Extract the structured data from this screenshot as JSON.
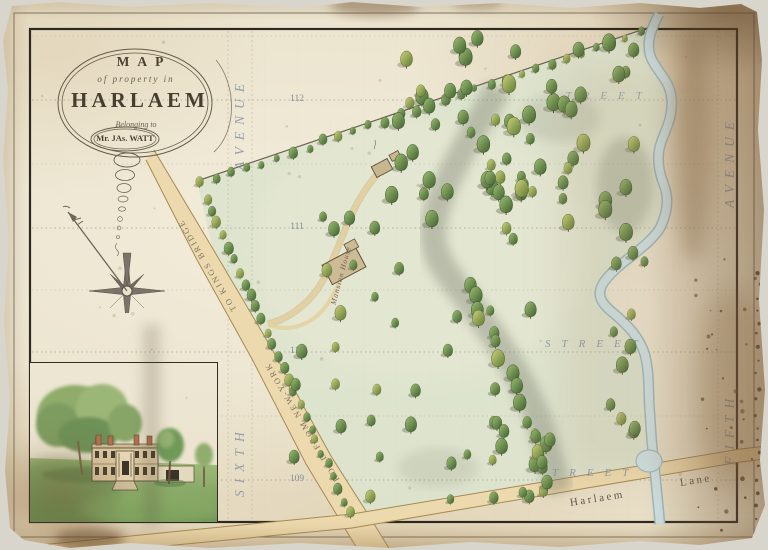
{
  "cartouche": {
    "word_map": "MAP",
    "line_of": "of property in",
    "word_harlaem": "HARLAEM",
    "line_belonging": "Belonging to",
    "owner": "Mr. JAs. WATT"
  },
  "roads": {
    "kingsbridge_upper": "TO KINGS BRIDGE",
    "kingsbridge_lower": "ROAD FROM NEW-YORK",
    "lane_name": "Harlaem",
    "lane_word": "Lane"
  },
  "avenues": {
    "sixth_upper": "AVENUE",
    "sixth_lower": "SIXTH",
    "fifth_upper": "AVENUE",
    "fifth_lower": "FIFTH"
  },
  "estate": {
    "mansion_label": "Mansion House"
  },
  "streets": [
    {
      "number": "112",
      "y": 100,
      "label": "STREET",
      "label_x": 549,
      "label_y": 90,
      "label_opacity": 0.8
    },
    {
      "number": "111",
      "y": 228,
      "label": "",
      "label_x": 0,
      "label_y": 0,
      "label_opacity": 0
    },
    {
      "number": "110",
      "y": 352,
      "label": "STREET",
      "label_x": 545,
      "label_y": 338,
      "label_opacity": 0.9
    },
    {
      "number": "109",
      "y": 480,
      "label": "TREET",
      "label_x": 552,
      "label_y": 467,
      "label_opacity": 0.9
    }
  ],
  "number_x": 282,
  "faint_lines": [
    36,
    164,
    290,
    416
  ],
  "avenue_lines": [
    228,
    252,
    718
  ],
  "colors": {
    "paper": "#eae2cc",
    "green": "#dce3cd",
    "road_fill": "#ecd9ad",
    "road_edge": "#a68a55",
    "river_fill": "#cfe2e4",
    "river_edge": "#9db9bf",
    "label_blue": "#8793a1",
    "ink": "#4a4134",
    "border": "#2e2820",
    "tree_dark": "#3f6130",
    "tree_light": "#9fbf72"
  },
  "tree_groups": [
    {
      "type": "row",
      "x1": 202,
      "y1": 185,
      "x2": 642,
      "y2": 32,
      "count": 30,
      "jitter": 2.5,
      "scale": 0.62
    },
    {
      "type": "row",
      "x1": 207,
      "y1": 200,
      "x2": 349,
      "y2": 514,
      "count": 27,
      "jitter": 2,
      "scale": 0.66
    },
    {
      "type": "scatter",
      "x": 382,
      "y": 38,
      "w": 258,
      "h": 212,
      "count": 56,
      "scale": 0.95
    },
    {
      "type": "scatter",
      "x": 598,
      "y": 248,
      "w": 52,
      "h": 195,
      "count": 11,
      "scale": 0.85
    },
    {
      "type": "row",
      "x1": 468,
      "y1": 288,
      "x2": 546,
      "y2": 452,
      "count": 15,
      "jitter": 7,
      "scale": 0.9
    },
    {
      "type": "grid",
      "x": 298,
      "y": 315,
      "w": 232,
      "h": 182,
      "cols": 7,
      "rows": 6,
      "skip": 0.38,
      "scale": 0.8
    },
    {
      "type": "scatter",
      "x": 428,
      "y": 418,
      "w": 122,
      "h": 85,
      "count": 9,
      "scale": 0.85
    },
    {
      "type": "scatter",
      "x": 292,
      "y": 196,
      "w": 112,
      "h": 128,
      "count": 9,
      "scale": 0.8
    },
    {
      "type": "scatter",
      "x": 528,
      "y": 428,
      "w": 42,
      "h": 62,
      "count": 5,
      "scale": 0.8
    },
    {
      "type": "row",
      "x1": 455,
      "y1": 95,
      "x2": 520,
      "y2": 240,
      "count": 10,
      "jitter": 8,
      "scale": 0.9
    }
  ]
}
